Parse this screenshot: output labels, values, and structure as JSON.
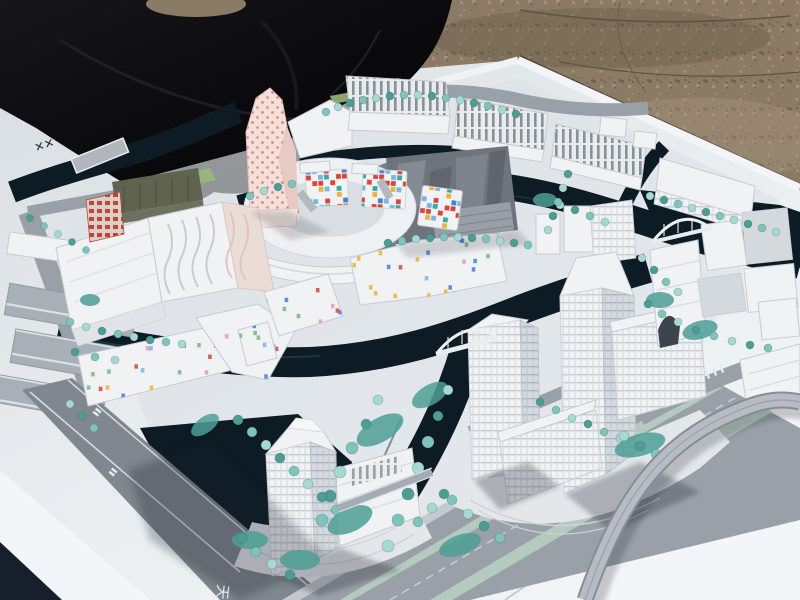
{
  "meta": {
    "type": "photograph",
    "subject": "white architectural scale model of a canal-side urban district",
    "setting": "model baseboard lying outdoors on a black tarp over gravel ground"
  },
  "features": [
    "black tarp backdrop",
    "gravel ground",
    "white model baseboard",
    "perimeter canal with flat bridge on board margin",
    "row of ribbed-roof halls along the top",
    "dark reflective glass block",
    "oval courtyard building with colored mosaic facade panels",
    "twisting pink tower speckled with red dots",
    "white slab blocks with wavy facade lines",
    "low-rise wings with scattered colored window confetti",
    "main canal with white arched footbridges",
    "high-rise tower cluster with gridded facades",
    "waterfront tower with stepped podium",
    "multi-lane boulevard with planted medians",
    "curved flyover ramp",
    "rows of teal foam street trees"
  ],
  "marks": {
    "board_stamp": "✕✕",
    "road_stamp_small_1": "〓",
    "road_stamp_small_2": "〓",
    "road_stamp_glyph": "天"
  },
  "palette": {
    "tarp": "#0d0d10",
    "tarpFold": "#26262c",
    "gravel": "#8b7a66",
    "gravelDark": "#6a5c49",
    "gravelLight": "#a8967e",
    "board": "#e8ecef",
    "boardBright": "#f3f6f8",
    "boardShade": "#d9dee2",
    "boardTint": "#dde2e6",
    "edgeShadow": "#2a241c",
    "water": "#0d1b24",
    "waterGlint": "#2a4a58",
    "navyCorner": "#161f2b",
    "road": "#9aa0a7",
    "roadDark": "#81878f",
    "sidewalk": "#c3c9cf",
    "laneLine": "#dde2e6",
    "median": "#b5cabf",
    "grass": "#9ab87c",
    "bldg": "#f0f2f4",
    "bldgShade": "#d4d9de",
    "bldgLine": "#c6ccd2",
    "plaza": "#e3e7ea",
    "glass": "#6e747c",
    "glassLight": "#8a9199",
    "glassDark": "#585e66",
    "glassFace": "#989fa7",
    "pink": "#f4e0da",
    "pinkShade": "#e7cac3",
    "pinkDot": "#dd7669",
    "olive": "#60634f",
    "redFacade": "#c04334",
    "redFacadeBg": "#d9d0ca",
    "tree": "#7fc3bc",
    "treeLight": "#a7d8d1",
    "treeDark": "#4d9d95",
    "shadow": "#1c242e",
    "markDark": "#2c323a",
    "markLight": "#e6ebef",
    "mosaic": [
      "#4a7fd4",
      "#d8453a",
      "#e8b43a",
      "#3aa8a0",
      "#7ab4e0",
      "#f2f4f6"
    ],
    "confetti": [
      "#d8453a",
      "#4a7fd4",
      "#e8b43a",
      "#7ab4e0",
      "#e89ab0",
      "#74b87a"
    ]
  }
}
